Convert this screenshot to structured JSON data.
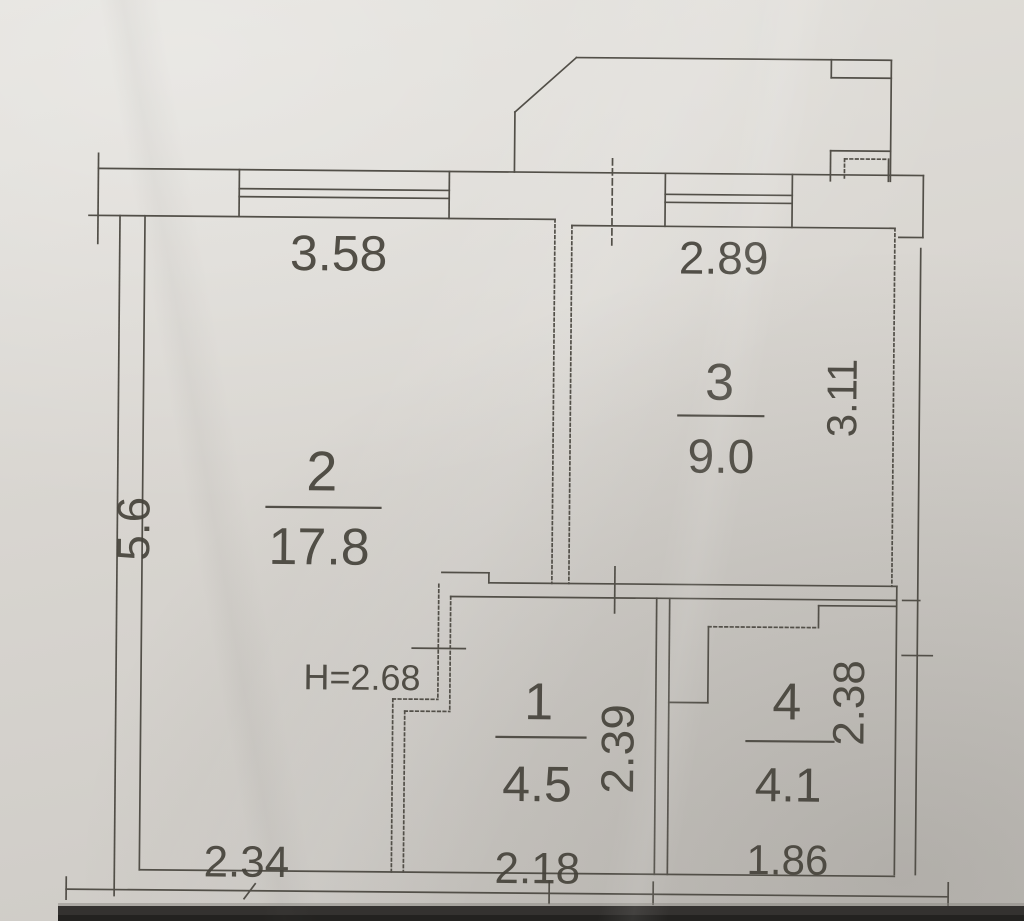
{
  "document_type": "scanned apartment floor plan",
  "ceiling_height_label": "H=2.68",
  "rooms": {
    "r1": {
      "number": "1",
      "area": "4.5",
      "dim_bottom": "2.18",
      "dim_right": "2.39"
    },
    "r2": {
      "number": "2",
      "area": "17.8",
      "dim_top": "3.58",
      "dim_left": "5.6",
      "dim_bottom": "2.34"
    },
    "r3": {
      "number": "3",
      "area": "9.0",
      "dim_top": "2.89",
      "dim_right": "3.11"
    },
    "r4": {
      "number": "4",
      "area": "4.1",
      "dim_bottom": "1.86",
      "dim_right": "2.38"
    }
  },
  "colors": {
    "paper": "#d9d6d1",
    "ink": "#524f48",
    "text": "#46433b",
    "photo_edge": "#343230"
  }
}
